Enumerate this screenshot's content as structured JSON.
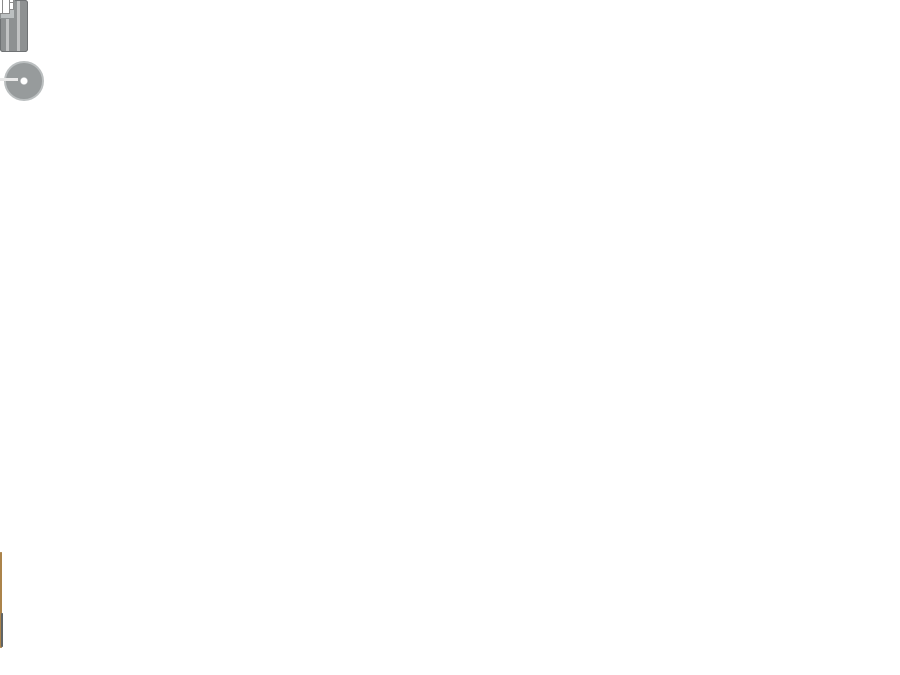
{
  "scene": {
    "type": "floor-plan",
    "subject": "chalet-with-deck",
    "text_labels": []
  },
  "colors": {
    "wall": "#161616",
    "interior-floor": "#c5812f",
    "deck-floor": "#dca850",
    "bath-floor": "#d7d1c4",
    "counter": "#262626",
    "steel": "#b6babb",
    "stove": "#d3d5d5",
    "mattress": "#d8d7d5",
    "duvet": "#55585a",
    "picnic-wood": "#682a0d",
    "cushion-back": "#54585a",
    "cushion-seat": "#7e8385",
    "chair": "#8e9192",
    "window": "#fbfbfb",
    "dash": "#7b7f81"
  },
  "rooms": {
    "bedroom_top": {
      "furniture": [
        "double-bed",
        "wardrobe"
      ]
    },
    "tech_alcove": {
      "furniture": [
        "round-table",
        "square-side-table"
      ]
    },
    "kitchen": {
      "furniture": [
        "black-counter",
        "sink",
        "faucet",
        "stove-4-burners"
      ]
    },
    "bathroom": {
      "furniture": [
        "shower",
        "toilet",
        "vanity-with-round-sink",
        "door-leaf",
        "sliding-door-dashed"
      ]
    },
    "bedroom_bottom": {
      "furniture": [
        "double-bed",
        "wardrobe",
        "shelf",
        "sliding-door-dashed"
      ]
    },
    "living": {
      "furniture": [
        "dining-table",
        "chair-x4",
        "side-table"
      ]
    },
    "deck": {
      "furniture": [
        "picnic-table",
        "picnic-bench-x2",
        "bracket-x4",
        "armchair-x2",
        "coffee-table"
      ]
    }
  },
  "windows": {
    "top_wall": 2,
    "right_wall": 3,
    "bottom_wall": 2
  }
}
